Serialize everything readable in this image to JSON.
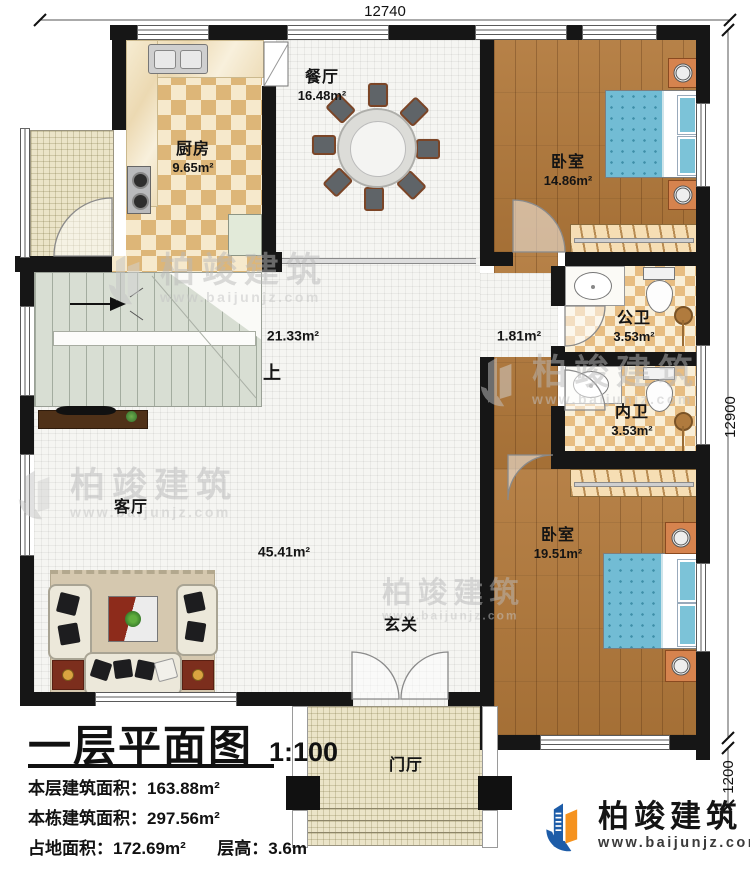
{
  "dimensions": {
    "top": "12740",
    "side": "12900",
    "porch": "1200"
  },
  "rooms": {
    "dining": {
      "name": "餐厅",
      "area": "16.48m²"
    },
    "kitchen": {
      "name": "厨房",
      "area": "9.65m²"
    },
    "bedroom1": {
      "name": "卧室",
      "area": "14.86m²"
    },
    "hall": {
      "area": "21.33m²"
    },
    "corridor": {
      "area": "1.81m²"
    },
    "public_bath": {
      "name": "公卫",
      "area": "3.53m²"
    },
    "inner_bath": {
      "name": "内卫",
      "area": "3.53m²"
    },
    "living": {
      "name": "客厅",
      "area": "45.41m²"
    },
    "bedroom2": {
      "name": "卧室",
      "area": "19.51m²"
    },
    "entry": {
      "name": "玄关"
    },
    "foyer": {
      "name": "门厅"
    },
    "stairs_up": {
      "label": "上"
    }
  },
  "title_block": {
    "title": "一层平面图",
    "scale": "1:100",
    "line1_label": "本层建筑面积：",
    "line1_value": "163.88m²",
    "line2_label": "本栋建筑面积：",
    "line2_value": "297.56m²",
    "line3_label": "占地面积：",
    "line3_value": "172.69m²",
    "line4_label": "层高：",
    "line4_value": "3.6m"
  },
  "brand": {
    "name": "柏竣建筑",
    "url": "www.baijunjz.com"
  },
  "watermark": {
    "name": "柏竣建筑",
    "url": "www.baijunjz.com"
  },
  "colors": {
    "wall": "#161616",
    "brand_blue": "#1d5ca8",
    "brand_orange": "#f5921e",
    "bed_blue": "#72bcd4"
  }
}
